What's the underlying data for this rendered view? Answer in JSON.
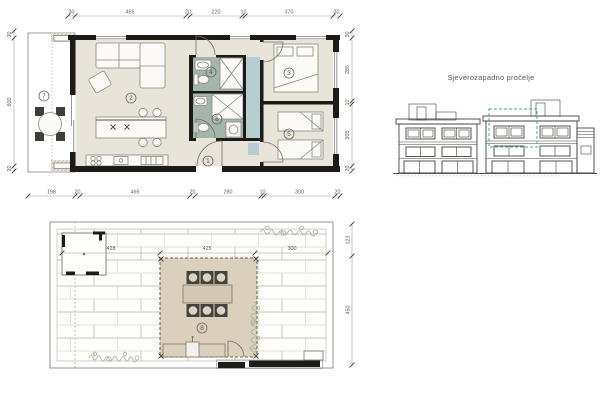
{
  "elevation": {
    "title": "Sjeverozapadno pročelje"
  },
  "floor_plan": {
    "rooms": {
      "hall": "1",
      "living": "2",
      "bedroom_main": "3",
      "bath_top": "4",
      "bedroom_twin": "5",
      "bath_bottom": "6",
      "terrace": "7"
    },
    "dims": {
      "top": [
        "30",
        "465",
        "20",
        "220",
        "10",
        "370",
        "30"
      ],
      "bottom": [
        "198",
        "20",
        "465",
        "20",
        "280",
        "10",
        "300",
        "20"
      ],
      "left": [
        "30",
        "600",
        "20"
      ],
      "right": [
        "30",
        "285",
        "10",
        "305",
        "20"
      ]
    }
  },
  "roof_plan": {
    "room": "8",
    "dims": {
      "inner": [
        "428",
        "425",
        "300"
      ],
      "right": [
        "123",
        "450"
      ]
    }
  },
  "colors": {
    "wall": "#1c1b18",
    "room_fill": "#e9e4da",
    "bath_fill": "#a4b6ab",
    "highlight_teal": "#b6ced2",
    "teal_line": "#4aa0b5",
    "pergola_fill": "#dbcfbe",
    "dim_text": "#63615a"
  }
}
